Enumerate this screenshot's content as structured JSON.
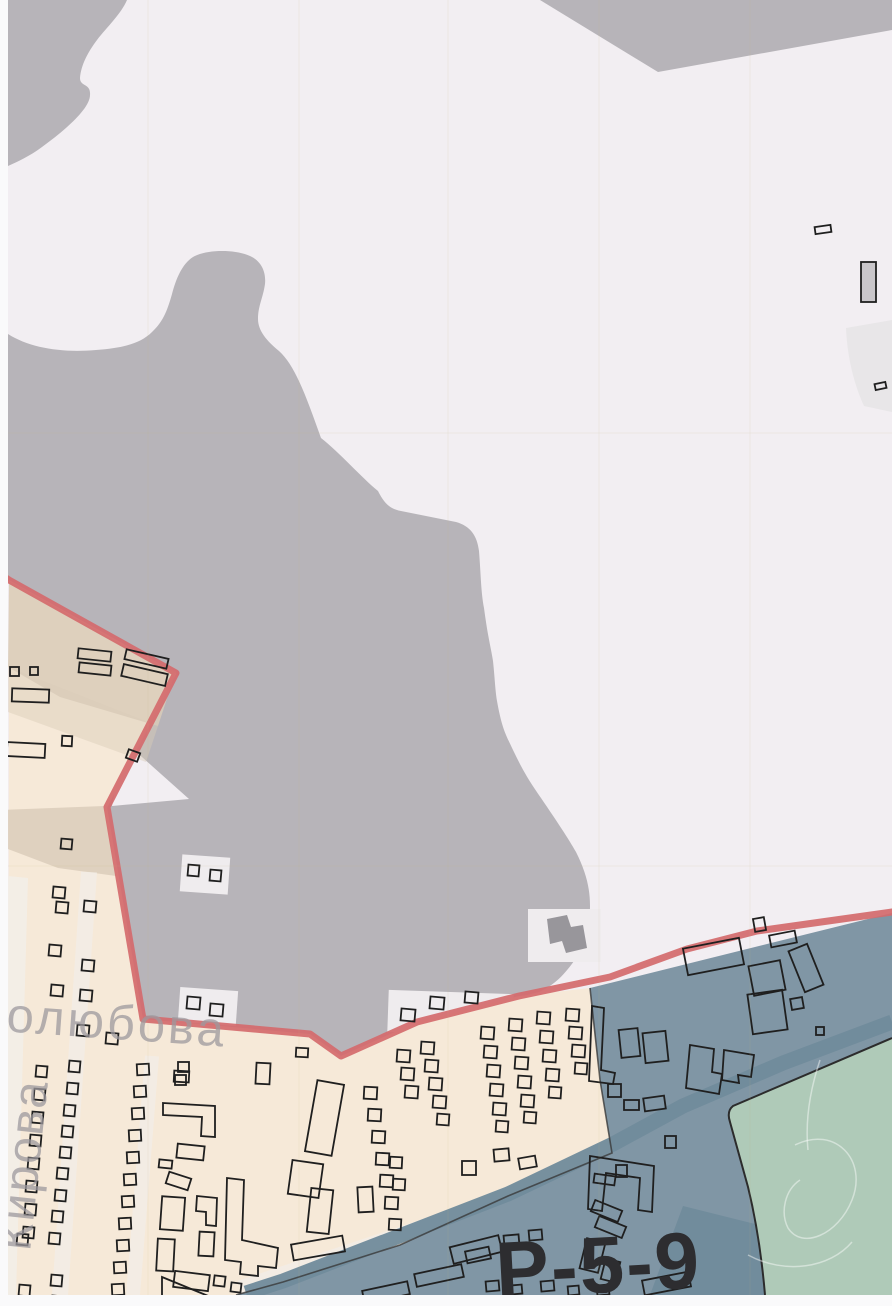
{
  "map": {
    "width": 892,
    "height": 1306,
    "colors": {
      "paper": "#f2eef2",
      "gray": "#b7b4b9",
      "beige": "#f6e9d8",
      "tan": "#d9cbb9",
      "pale": "#f1ece9",
      "pale_block": "#efecee",
      "street": "#f3eee8",
      "blue": "#8096a5",
      "blue_dark": "#708b9b",
      "green": "#afcab8",
      "green_edge": "#2c2c2c",
      "red": "#d46a6c",
      "outline": "#1f1f1f",
      "building_fill_gray": "#c9c6ca",
      "mini_blob": "#98969b",
      "label_gray": "#9d999e",
      "zone_label_color": "#2d2d30",
      "margin": "#fafafb",
      "boundary_dark": "#3a3a3a",
      "scribble": "#ffffff",
      "top_right_pale": "#e8e6e8",
      "fold": "rgba(200,185,120,0.12)"
    },
    "zones": {
      "gray_top_left": "M8,0 L127,0 C121,14 107,27 97,40 C88,52 81,65 80,78 C80,87 91,83 90,95 C90,109 64,131 42,147 C30,156 17,162 8,166 Z",
      "gray_wedge": "M540,0 L892,0 L892,30 L658,72 Z",
      "gray_blob": "M8,334 C30,348 62,353 96,350 C122,348 140,344 152,332 C164,321 168,308 172,294 C176,279 182,264 193,257 C207,249 237,249 252,257 C263,263 266,274 265,284 C263,298 258,306 258,319 C258,331 267,341 279,351 C296,366 308,402 321,438 C340,453 361,477 378,491 C385,505 391,509 401,511 L456,522 C470,526 477,535 479,551 C481,577 481,592 484,608 C488,638 491,648 493,661 C495,680 495,688 497,701 C502,729 506,735 513,750 C524,773 530,782 541,798 C558,823 568,838 576,852 C586,872 590,888 590,906 C590,932 584,947 574,961 C562,978 552,986 539,992 L519,997 L417,1023 L341,1056 L310,1035 L143,1020 L107,808 L176,674 L9,581 L8,581 Z",
      "pale_triangle": "M124,741 L189,799 L112,806 Z",
      "beige": "M9,580 L176,673 L107,807 L143,1019 L310,1034 L341,1056 L417,1022 L519,996 L590,988 L600,1080 L612,1153 L508,1196 L400,1245 L283,1282 L236,1295 L8,1295 Z",
      "tan1": "M9,581 L142,656 L176,671 L158,726 L60,697 L8,667 Z",
      "tan2": "M8,667 L158,726 L146,762 L8,712 Z",
      "tan3": "M0,810 L104,806 L116,876 L58,868 L0,846 Z",
      "kirova_street": "M8,876 L28,878 L16,1295 L8,1295 Z",
      "blue": "M590,988 L892,913 L892,1295 L236,1295 L283,1282 L400,1245 L508,1196 L612,1153 L600,1080 Z",
      "blue_parallelogram": "M683,1206 L755,1224 L765,1295 L650,1295 Z",
      "green": "M892,1038 L733,1106 C728,1110 728,1116 730,1122 L748,1187 C756,1220 762,1260 765,1295 L892,1295 Z",
      "green_edge_line": "M892,1038 L733,1106 C728,1110 728,1116 730,1122 L748,1187 C756,1220 762,1260 765,1295",
      "top_right_pale_poly": "M846,328 L892,320 L892,412 L864,406 C852,380 847,352 846,328 Z",
      "mini_gray_blob": "M547,919 L567,915 L571,927 L583,925 L587,948 L566,953 L562,941 L550,944 Z"
    },
    "pale_blocks": [
      [
        388,
        992,
        125,
        42,
        2
      ],
      [
        528,
        909,
        73,
        53,
        0
      ],
      [
        179,
        989,
        58,
        35,
        4
      ],
      [
        181,
        856,
        48,
        37,
        4
      ]
    ],
    "street_strokes": [
      {
        "x1": 89,
        "y1": 872,
        "x2": 60,
        "y2": 1295,
        "w": 16
      },
      {
        "x1": 152,
        "y1": 1056,
        "x2": 133,
        "y2": 1295,
        "w": 14
      },
      {
        "x1": 500,
        "y1": 1200,
        "x2": 240,
        "y2": 1287,
        "w": 13
      }
    ],
    "road_band_points": "892,1022 783,1063 683,1106 613,1144 508,1194 283,1281 246,1293",
    "boundary_dark_path": "M590,988 L600,1080 L612,1153 L508,1196 L400,1245 L283,1282 L236,1295",
    "red_boundary": {
      "points": "0,574 9,580 176,673 107,807 143,1019 310,1034 341,1056 417,1022 519,996 610,977 687,949 757,931 892,912",
      "width": 7
    },
    "scribbles": [
      "M795,1145 C835,1125 868,1160 852,1200 C838,1235 802,1250 788,1228 C780,1212 785,1190 800,1180",
      "M748,1255 C785,1275 830,1268 852,1242",
      "M820,1060 C810,1090 805,1120 808,1150"
    ],
    "buildings": {
      "rects": [
        [
          815,
          226,
          16,
          7,
          -8
        ],
        [
          875,
          383,
          11,
          6,
          -12
        ],
        [
          754,
          918,
          11,
          13,
          -10
        ],
        [
          10,
          667,
          9,
          9,
          0
        ],
        [
          30,
          667,
          8,
          8,
          0
        ],
        [
          78,
          650,
          33,
          10,
          6
        ],
        [
          79,
          664,
          32,
          10,
          6
        ],
        [
          125,
          654,
          43,
          10,
          13
        ],
        [
          122,
          669,
          45,
          12,
          13
        ],
        [
          12,
          689,
          37,
          13,
          2
        ],
        [
          7,
          743,
          38,
          14,
          3
        ],
        [
          62,
          736,
          10,
          10,
          3
        ],
        [
          127,
          751,
          12,
          9,
          20
        ],
        [
          61,
          839,
          11,
          10,
          5
        ],
        [
          188,
          865,
          11,
          11,
          5
        ],
        [
          210,
          870,
          11,
          11,
          5
        ],
        [
          53,
          887,
          12,
          11,
          5
        ],
        [
          56,
          902,
          12,
          11,
          5
        ],
        [
          84,
          901,
          12,
          11,
          5
        ],
        [
          49,
          945,
          12,
          11,
          5
        ],
        [
          82,
          960,
          12,
          11,
          5
        ],
        [
          51,
          985,
          12,
          11,
          5
        ],
        [
          80,
          990,
          12,
          11,
          5
        ],
        [
          77,
          1025,
          12,
          11,
          5
        ],
        [
          106,
          1033,
          12,
          11,
          5
        ],
        [
          187,
          997,
          13,
          12,
          5
        ],
        [
          210,
          1004,
          13,
          12,
          5
        ],
        [
          401,
          1009,
          14,
          12,
          5
        ],
        [
          430,
          997,
          14,
          12,
          5
        ],
        [
          465,
          992,
          13,
          11,
          5
        ],
        [
          36,
          1066,
          11,
          11,
          5
        ],
        [
          34,
          1089,
          11,
          11,
          5
        ],
        [
          32,
          1112,
          11,
          11,
          5
        ],
        [
          30,
          1135,
          11,
          11,
          5
        ],
        [
          28,
          1158,
          11,
          11,
          5
        ],
        [
          26,
          1181,
          11,
          11,
          5
        ],
        [
          25,
          1204,
          11,
          11,
          5
        ],
        [
          23,
          1227,
          11,
          11,
          5
        ],
        [
          17,
          1234,
          11,
          11,
          5
        ],
        [
          19,
          1285,
          11,
          11,
          5
        ],
        [
          69,
          1061,
          11,
          11,
          5
        ],
        [
          67,
          1083,
          11,
          11,
          5
        ],
        [
          64,
          1105,
          11,
          11,
          5
        ],
        [
          62,
          1126,
          11,
          11,
          5
        ],
        [
          60,
          1147,
          11,
          11,
          5
        ],
        [
          57,
          1168,
          11,
          11,
          5
        ],
        [
          55,
          1190,
          11,
          11,
          5
        ],
        [
          52,
          1211,
          11,
          11,
          5
        ],
        [
          49,
          1233,
          11,
          11,
          5
        ],
        [
          51,
          1275,
          11,
          11,
          5
        ],
        [
          52,
          1296,
          11,
          8,
          5
        ],
        [
          137,
          1064,
          12,
          11,
          -3
        ],
        [
          134,
          1086,
          12,
          11,
          -3
        ],
        [
          132,
          1108,
          12,
          11,
          -3
        ],
        [
          129,
          1130,
          12,
          11,
          -3
        ],
        [
          127,
          1152,
          12,
          11,
          -3
        ],
        [
          124,
          1174,
          12,
          11,
          -3
        ],
        [
          122,
          1196,
          12,
          11,
          -3
        ],
        [
          119,
          1218,
          12,
          11,
          -3
        ],
        [
          117,
          1240,
          12,
          11,
          -3
        ],
        [
          114,
          1262,
          12,
          11,
          -3
        ],
        [
          112,
          1284,
          12,
          11,
          -3
        ],
        [
          178,
          1062,
          11,
          10,
          0
        ],
        [
          175,
          1075,
          11,
          10,
          0
        ],
        [
          177,
          1145,
          27,
          14,
          6
        ],
        [
          159,
          1160,
          13,
          8,
          6
        ],
        [
          167,
          1175,
          23,
          12,
          18
        ],
        [
          161,
          1197,
          23,
          33,
          4
        ],
        [
          157,
          1239,
          17,
          32,
          3
        ],
        [
          199,
          1232,
          15,
          24,
          3
        ],
        [
          174,
          1273,
          35,
          16,
          7
        ],
        [
          214,
          1276,
          11,
          10,
          7
        ],
        [
          231,
          1283,
          10,
          9,
          7
        ],
        [
          256,
          1063,
          14,
          21,
          3
        ],
        [
          296,
          1048,
          12,
          9,
          3
        ],
        [
          174,
          1071,
          15,
          11,
          3
        ],
        [
          311,
          1082,
          27,
          72,
          10
        ],
        [
          290,
          1162,
          31,
          34,
          8
        ],
        [
          309,
          1189,
          22,
          44,
          6
        ],
        [
          292,
          1240,
          52,
          16,
          -10
        ],
        [
          358,
          1187,
          15,
          25,
          -3
        ],
        [
          364,
          1087,
          13,
          12,
          3
        ],
        [
          368,
          1109,
          13,
          12,
          3
        ],
        [
          372,
          1131,
          13,
          12,
          3
        ],
        [
          376,
          1153,
          13,
          12,
          3
        ],
        [
          380,
          1175,
          13,
          12,
          3
        ],
        [
          390,
          1157,
          12,
          11,
          3
        ],
        [
          393,
          1179,
          12,
          11,
          3
        ],
        [
          385,
          1197,
          13,
          12,
          3
        ],
        [
          389,
          1219,
          12,
          11,
          3
        ],
        [
          397,
          1050,
          13,
          12,
          4
        ],
        [
          401,
          1068,
          13,
          12,
          4
        ],
        [
          405,
          1086,
          13,
          12,
          4
        ],
        [
          421,
          1042,
          13,
          12,
          4
        ],
        [
          425,
          1060,
          13,
          12,
          4
        ],
        [
          429,
          1078,
          13,
          12,
          4
        ],
        [
          433,
          1096,
          13,
          12,
          4
        ],
        [
          437,
          1114,
          12,
          11,
          4
        ],
        [
          481,
          1027,
          13,
          12,
          4
        ],
        [
          484,
          1046,
          13,
          12,
          4
        ],
        [
          487,
          1065,
          13,
          12,
          4
        ],
        [
          490,
          1084,
          13,
          12,
          4
        ],
        [
          493,
          1103,
          13,
          12,
          4
        ],
        [
          496,
          1121,
          12,
          11,
          4
        ],
        [
          509,
          1019,
          13,
          12,
          4
        ],
        [
          512,
          1038,
          13,
          12,
          4
        ],
        [
          515,
          1057,
          13,
          12,
          4
        ],
        [
          518,
          1076,
          13,
          12,
          4
        ],
        [
          521,
          1095,
          13,
          12,
          4
        ],
        [
          524,
          1112,
          12,
          11,
          4
        ],
        [
          537,
          1012,
          13,
          12,
          4
        ],
        [
          540,
          1031,
          13,
          12,
          4
        ],
        [
          543,
          1050,
          13,
          12,
          4
        ],
        [
          546,
          1069,
          13,
          12,
          4
        ],
        [
          549,
          1087,
          12,
          11,
          4
        ],
        [
          566,
          1009,
          13,
          12,
          4
        ],
        [
          569,
          1027,
          13,
          12,
          4
        ],
        [
          572,
          1045,
          13,
          12,
          4
        ],
        [
          575,
          1063,
          12,
          11,
          4
        ],
        [
          685,
          943,
          57,
          27,
          -11
        ],
        [
          770,
          933,
          26,
          12,
          -11
        ],
        [
          796,
          946,
          20,
          44,
          -22
        ],
        [
          751,
          963,
          32,
          30,
          -11
        ],
        [
          750,
          992,
          35,
          40,
          -8
        ],
        [
          791,
          998,
          12,
          11,
          -10
        ],
        [
          816,
          1027,
          8,
          8,
          0
        ],
        [
          620,
          1029,
          19,
          28,
          -6
        ],
        [
          644,
          1032,
          23,
          30,
          -6
        ],
        [
          608,
          1084,
          13,
          13,
          0
        ],
        [
          624,
          1100,
          15,
          10,
          0
        ],
        [
          644,
          1097,
          21,
          13,
          -8
        ],
        [
          594,
          1175,
          21,
          9,
          8
        ],
        [
          616,
          1165,
          11,
          12,
          0
        ],
        [
          592,
          1205,
          29,
          12,
          22
        ],
        [
          596,
          1221,
          29,
          12,
          22
        ],
        [
          665,
          1136,
          11,
          12,
          0
        ],
        [
          583,
          1240,
          19,
          31,
          14
        ],
        [
          603,
          1260,
          15,
          21,
          14
        ],
        [
          462,
          1161,
          14,
          14,
          0
        ],
        [
          494,
          1149,
          15,
          12,
          -5
        ],
        [
          519,
          1157,
          17,
          11,
          -10
        ],
        [
          504,
          1235,
          15,
          11,
          -5
        ],
        [
          529,
          1230,
          13,
          10,
          -5
        ],
        [
          451,
          1241,
          50,
          17,
          -14
        ],
        [
          363,
          1286,
          46,
          13,
          -12
        ],
        [
          415,
          1269,
          48,
          13,
          -12
        ],
        [
          466,
          1249,
          24,
          12,
          -12
        ],
        [
          486,
          1281,
          13,
          10,
          -5
        ],
        [
          511,
          1285,
          11,
          9,
          -5
        ],
        [
          541,
          1281,
          13,
          10,
          -5
        ],
        [
          568,
          1286,
          11,
          9,
          -5
        ],
        [
          597,
          1285,
          12,
          10,
          -5
        ],
        [
          643,
          1276,
          47,
          15,
          -11
        ]
      ],
      "filled_gray": [
        [
          861,
          262,
          15,
          40,
          0
        ]
      ],
      "polygons": [
        "163,1103 215,1106 215,1137 201,1136 202,1117 163,1115",
        "197,1196 217,1198 216,1226 206,1225 206,1212 196,1211",
        "162,1277 218,1300 162,1303",
        "227,1178 244,1180 242,1240 278,1248 276,1268 258,1266 258,1276 240,1274 241,1262 225,1260",
        "592,1006 604,1008 601,1070 615,1073 613,1084 589,1081",
        "690,1045 714,1049 712,1072 722,1074 719,1094 686,1088",
        "724,1050 754,1055 751,1077 738,1075 739,1083 722,1080",
        "590,1156 654,1166 652,1212 638,1210 640,1178 606,1173 602,1211 588,1209"
      ]
    },
    "labels": [
      {
        "id": "street-bogolyubova",
        "text": "голюбова",
        "x": -14,
        "y": 1030,
        "size": 49,
        "rotate": 4,
        "weight": 400,
        "spacing": 3,
        "opacity": 0.75
      },
      {
        "id": "street-kirova",
        "text": "Кирова",
        "x": 30,
        "y": 1252,
        "size": 48,
        "rotate": -84,
        "weight": 400,
        "spacing": 2,
        "opacity": 0.75
      },
      {
        "id": "zone-code",
        "text": "Р-5-9",
        "x": 497,
        "y": 1298,
        "size": 80,
        "rotate": -3,
        "weight": 900,
        "spacing": 2,
        "opacity": 1
      }
    ],
    "fold_lines": {
      "vertical": [
        148,
        299,
        448,
        599,
        750
      ],
      "horizontal": [
        433,
        866
      ]
    }
  }
}
